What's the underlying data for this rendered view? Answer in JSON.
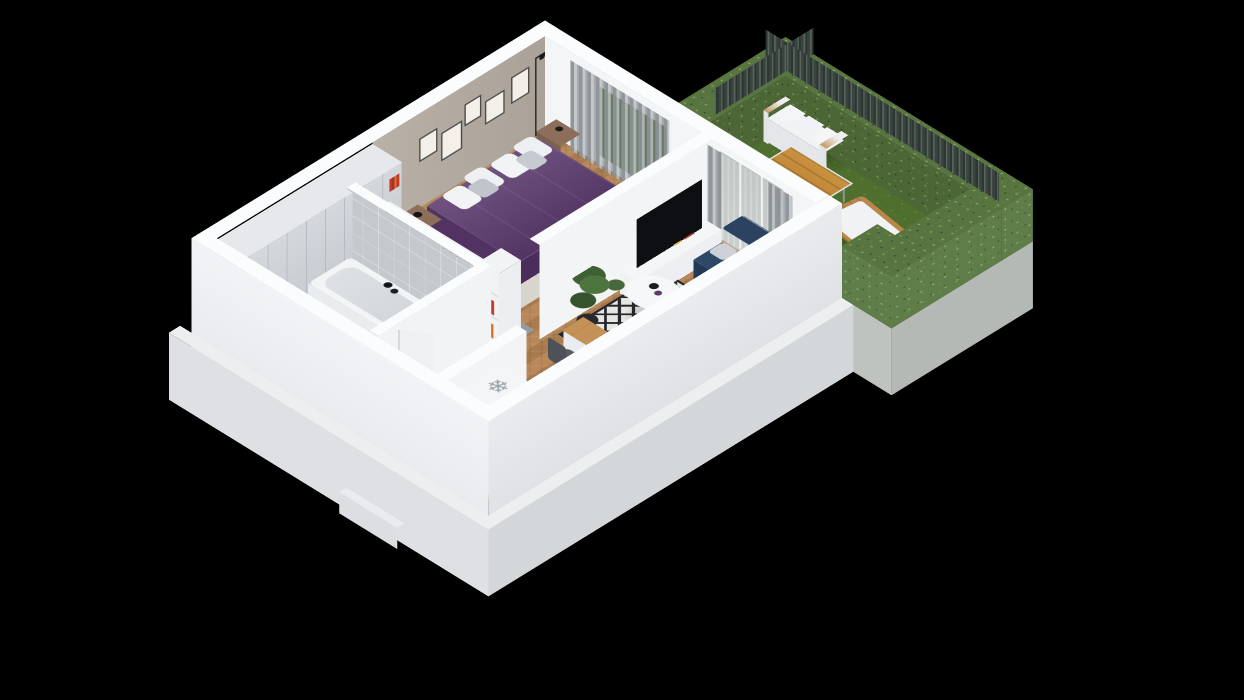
{
  "scene": {
    "description": "Isometric 3D cutaway render of a one-bedroom apartment floor plan with an enclosed hedge garden terrace, floating on a black background",
    "background_color": "#000000"
  },
  "icons": {
    "snowflake": "❄"
  },
  "palette": {
    "wall_white": "#f3f4f6",
    "wall_top": "#fbfcfd",
    "wall_outer_se": "#e7e9ec",
    "wall_outer_sw": "#f0f1f4",
    "bedroom_accent_wall": "#b4aba1",
    "wardrobe": "#ccd0d5",
    "bed_duvet_purple": "#5c3a6e",
    "sofa_navy": "#2e4866",
    "wood_floor": "#b2824e",
    "concrete_floor": "#9aa0a4",
    "bath_tile": "#c4c9cd",
    "rug_light": "#e7e6e2",
    "rug_dark": "#24262b",
    "grass_green": "#4f6f2e",
    "hedge_green": "#587440",
    "fence_gray_green": "#3c4743",
    "outdoor_wood": "#c28a3b",
    "tv_black": "#0e0f12",
    "red_books": "#c0392b"
  },
  "objects": [
    "bedroom: double bed, pillows, nightstands, framed pictures, floor lamp, window curtains",
    "walk-in corridor: wardrobe, clothes rack, red book shelf",
    "bathroom: bathtub, shower trays, vanity, door ajar",
    "living room: corner sofa, round coffee table, patterned rug, TV stand, TV, potted plants, desk with chairs",
    "kitchen: counter with cooktop and sink, coffee machine, fridge marked with snowflake",
    "garden: grass lawn, hedge walls, slat fence, outdoor sofa, wooden coffee table, sun lounger"
  ]
}
